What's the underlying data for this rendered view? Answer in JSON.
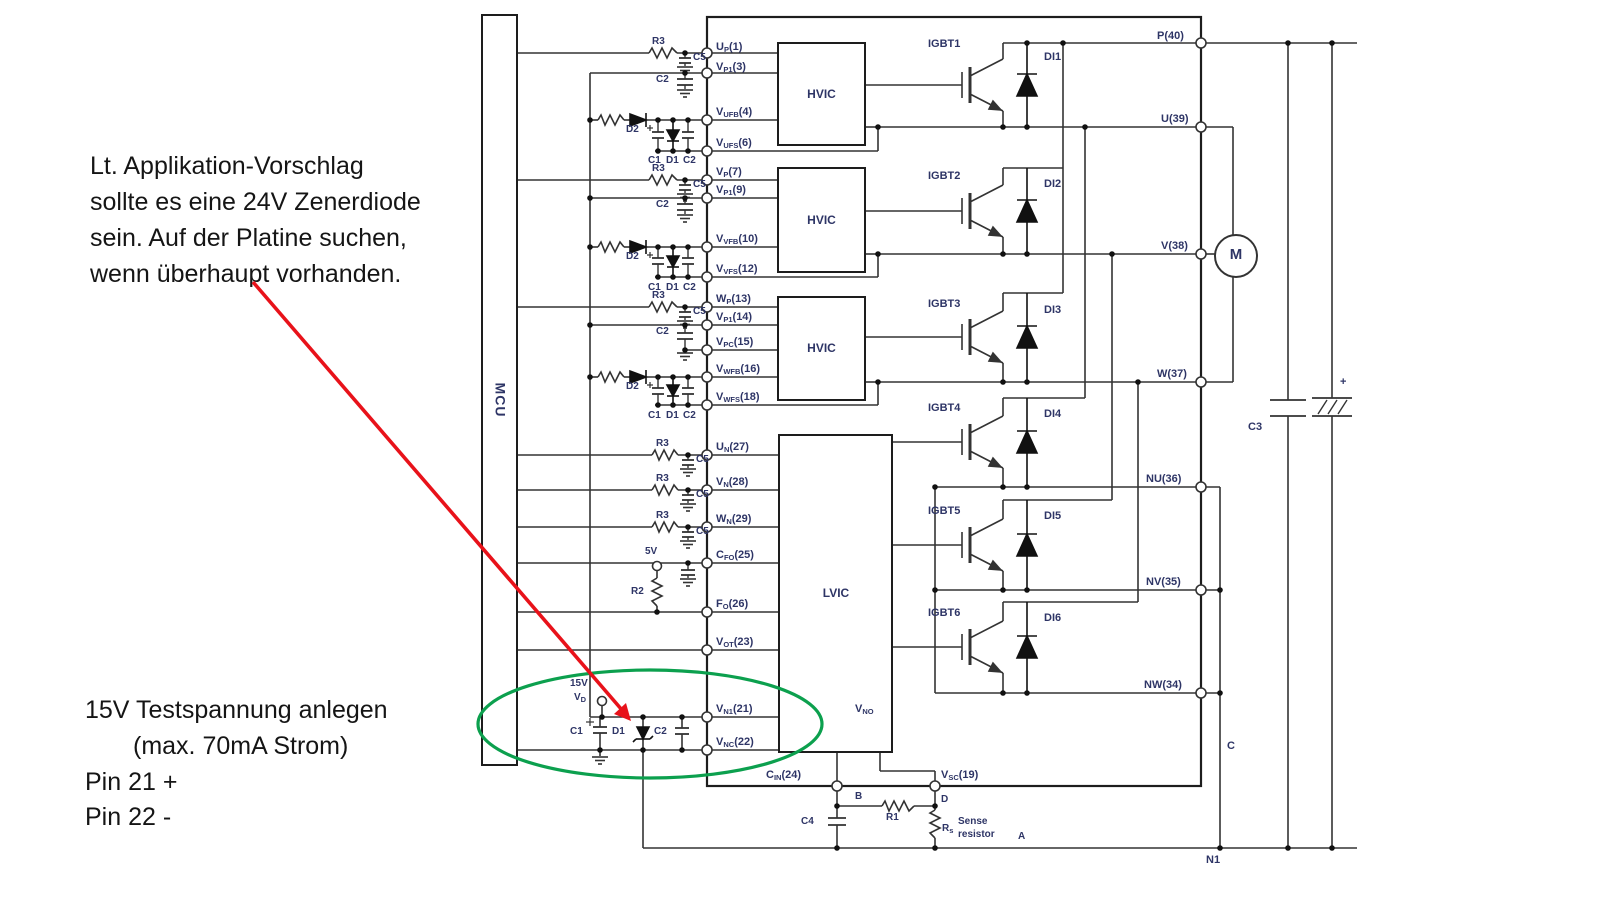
{
  "annotations": {
    "note1_lines": [
      "Lt. Applikation-Vorschlag",
      "sollte es eine 24V Zenerdiode",
      "sein. Auf der Platine suchen,",
      "wenn überhaupt vorhanden."
    ],
    "note2_lines": [
      "15V Testspannung anlegen",
      "(max. 70mA Strom)",
      "Pin 21 +",
      "Pin 22 -"
    ]
  },
  "blocks": {
    "mcu": "MCU",
    "hvic": "HVIC",
    "lvic": "LVIC",
    "vno": {
      "b": "V",
      "s": "NO"
    }
  },
  "pins_left": [
    {
      "b": "U",
      "s": "P",
      "r": "(1)"
    },
    {
      "b": "V",
      "s": "P1",
      "r": "(3)"
    },
    {
      "b": "V",
      "s": "UFB",
      "r": "(4)"
    },
    {
      "b": "V",
      "s": "UFS",
      "r": "(6)"
    },
    {
      "b": "V",
      "s": "P",
      "r": "(7)"
    },
    {
      "b": "V",
      "s": "P1",
      "r": "(9)"
    },
    {
      "b": "V",
      "s": "VFB",
      "r": "(10)"
    },
    {
      "b": "V",
      "s": "VFS",
      "r": "(12)"
    },
    {
      "b": "W",
      "s": "P",
      "r": "(13)"
    },
    {
      "b": "V",
      "s": "P1",
      "r": "(14)"
    },
    {
      "b": "V",
      "s": "PC",
      "r": "(15)"
    },
    {
      "b": "V",
      "s": "WFB",
      "r": "(16)"
    },
    {
      "b": "V",
      "s": "WFS",
      "r": "(18)"
    },
    {
      "b": "U",
      "s": "N",
      "r": "(27)"
    },
    {
      "b": "V",
      "s": "N",
      "r": "(28)"
    },
    {
      "b": "W",
      "s": "N",
      "r": "(29)"
    },
    {
      "b": "C",
      "s": "FO",
      "r": "(25)"
    },
    {
      "b": "F",
      "s": "O",
      "r": "(26)"
    },
    {
      "b": "V",
      "s": "OT",
      "r": "(23)"
    },
    {
      "b": "V",
      "s": "N1",
      "r": "(21)"
    },
    {
      "b": "V",
      "s": "NC",
      "r": "(22)"
    }
  ],
  "pins_bottom": [
    {
      "b": "C",
      "s": "IN",
      "r": "(24)"
    },
    {
      "b": "V",
      "s": "SC",
      "r": "(19)"
    }
  ],
  "pins_right": [
    "P(40)",
    "U(39)",
    "V(38)",
    "W(37)",
    "NU(36)",
    "NV(35)",
    "NW(34)"
  ],
  "igbt_labels": [
    "IGBT1",
    "IGBT2",
    "IGBT3",
    "IGBT4",
    "IGBT5",
    "IGBT6"
  ],
  "di_labels": [
    "DI1",
    "DI2",
    "DI3",
    "DI4",
    "DI5",
    "DI6"
  ],
  "parts": {
    "r1": "R1",
    "r2": "R2",
    "r3": "R3",
    "c1": "C1",
    "c2": "C2",
    "c3": "C3",
    "c4": "C4",
    "c5": "C5",
    "d1": "D1",
    "d2": "D2",
    "rs": {
      "b": "R",
      "s": "s"
    },
    "vd": {
      "b": "V",
      "s": "D"
    },
    "supply_5v": "5V",
    "supply_15v": "15V",
    "sense_line1": "Sense",
    "sense_line2": "resistor"
  },
  "nodes": {
    "a": "A",
    "b": "B",
    "c": "C",
    "d": "D",
    "n1": "N1",
    "plus": "+",
    "motor": "M"
  },
  "colors": {
    "wire": "#333333",
    "outline": "#1d1d1d",
    "label": "#2e3566",
    "annotation": "#151515",
    "arrow": "#e8121a",
    "ellipse": "#0ca04e"
  }
}
